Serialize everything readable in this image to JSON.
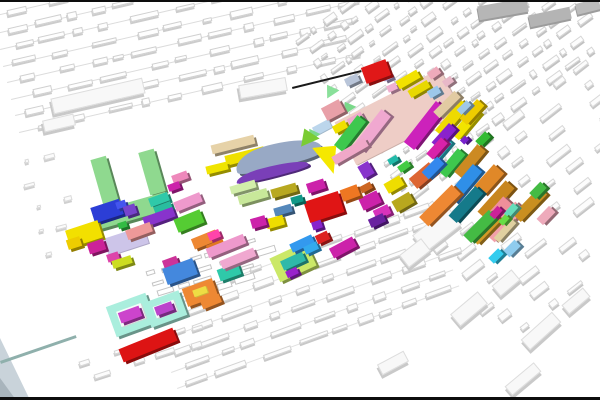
{
  "scene": {
    "width": 600,
    "height": 400,
    "background": "#ffffff",
    "bars": [
      {
        "y": 0,
        "h": 2,
        "color": "#0d0d0d"
      },
      {
        "y": 397,
        "h": 3,
        "color": "#0d0d0d"
      }
    ],
    "corner_shapes": [
      {
        "x": 0,
        "y": 338,
        "w": 30,
        "h": 62,
        "clip": "polygon(0 0,100% 100%,0 100%)",
        "color": "#c9d3da"
      },
      {
        "x": 0,
        "y": 378,
        "w": 16,
        "h": 22,
        "clip": "polygon(0 0,100% 100%,0 100%)",
        "color": "#a8b4bc"
      }
    ],
    "lines": [
      {
        "cx": 327,
        "cy": 87,
        "len": 71,
        "h": 1.5,
        "angle": -13.8,
        "color": "#1a1a1a"
      },
      {
        "cx": 40,
        "cy": 361,
        "len": 80,
        "h": 3,
        "angle": -18.9,
        "color": "#8fb0ac"
      }
    ],
    "fields_format": "procedural white building rows: origin x/y, row angle deg, rows, row_gap px, row_len px, block w/h ranges, gap range, optional row line color",
    "fields": [
      {
        "seed": 11,
        "x": -8,
        "y": 16,
        "angle": -13,
        "rows": 8,
        "row_gap": 17,
        "row_len": 352,
        "bw": [
          8,
          30
        ],
        "bh": [
          4,
          7
        ],
        "gap": [
          5,
          26
        ],
        "line": "#dcdcdc",
        "fill": "#fefefe",
        "edge": "#d0d0d0",
        "sh": "#cccccc"
      },
      {
        "seed": 23,
        "x": 398,
        "y": 190,
        "angle": -36,
        "rows": 13,
        "row_gap": -15,
        "row_len": 255,
        "bw": [
          5,
          18
        ],
        "bh": [
          3,
          7
        ],
        "gap": [
          2,
          12
        ],
        "line": null,
        "fill": "#fdfdfd",
        "edge": "#d6d6d6",
        "sh": "#c2c2c2"
      },
      {
        "seed": 37,
        "x": 385,
        "y": 218,
        "angle": -38,
        "rows": 10,
        "row_gap": 19,
        "row_len": 270,
        "bw": [
          8,
          28
        ],
        "bh": [
          4,
          8
        ],
        "gap": [
          8,
          42
        ],
        "line": null,
        "fill": "#fcfcfc",
        "edge": "#d8d8d8",
        "sh": "#c6c6c6"
      },
      {
        "seed": 51,
        "x": 148,
        "y": 308,
        "angle": -20,
        "rows": 6,
        "row_gap": 17,
        "row_len": 300,
        "bw": [
          10,
          34
        ],
        "bh": [
          4,
          7
        ],
        "gap": [
          4,
          20
        ],
        "line": "#e2e2e2",
        "fill": "#fdfdfd",
        "edge": "#d4d4d4",
        "sh": "#c8c8c8"
      },
      {
        "seed": 63,
        "x": 142,
        "y": 276,
        "angle": -17,
        "rows": 4,
        "row_gap": 11,
        "row_len": 122,
        "bw": [
          8,
          26
        ],
        "bh": [
          4,
          7
        ],
        "gap": [
          3,
          10
        ],
        "line": null,
        "fill": "#ffffff",
        "edge": "#c4c4c4",
        "sh": null
      },
      {
        "seed": 77,
        "x": 2,
        "y": 168,
        "angle": -15,
        "rows": 5,
        "row_gap": 24,
        "row_len": 66,
        "bw": [
          4,
          12
        ],
        "bh": [
          3,
          5
        ],
        "gap": [
          12,
          40
        ],
        "line": null,
        "fill": "#fbfbfb",
        "edge": "#dadada",
        "sh": "#cfcfcf"
      },
      {
        "seed": 85,
        "x": 60,
        "y": 372,
        "angle": -18,
        "rows": 2,
        "row_gap": 15,
        "row_len": 150,
        "bw": [
          6,
          20
        ],
        "bh": [
          3,
          6
        ],
        "gap": [
          10,
          34
        ],
        "line": null,
        "fill": "#fcfcfc",
        "edge": "#d6d6d6",
        "sh": "#c9c9c9"
      }
    ],
    "gray_slabs": [
      [
        503,
        9,
        50,
        14,
        -10,
        "#b6b6b6"
      ],
      [
        550,
        17,
        42,
        12,
        -12,
        "#b4b4b4"
      ],
      [
        588,
        6,
        24,
        11,
        -14,
        "#bbbbbb"
      ]
    ],
    "white_slabs": [
      [
        97,
        95,
        92,
        14,
        -13
      ],
      [
        58,
        122,
        30,
        10,
        -13
      ],
      [
        262,
        87,
        46,
        12,
        -10
      ],
      [
        436,
        229,
        44,
        20,
        -38
      ],
      [
        414,
        252,
        26,
        14,
        -38
      ],
      [
        468,
        308,
        34,
        14,
        -40
      ],
      [
        540,
        330,
        40,
        12,
        -42
      ],
      [
        505,
        282,
        24,
        12,
        -40
      ],
      [
        392,
        362,
        28,
        10,
        -28
      ],
      [
        522,
        378,
        36,
        10,
        -40
      ],
      [
        575,
        300,
        26,
        10,
        -40
      ]
    ],
    "buildings_format": "[cx, cy, w, h, rot_deg, roof_color, shape(optional: flat|tri|wedge|arc|arc2)]",
    "buildings": [
      [
        398,
        117,
        118,
        48,
        -27,
        "#eecdc6",
        "flat"
      ],
      [
        126,
        241,
        42,
        18,
        -18,
        "#cdc5e9",
        "flat"
      ],
      [
        322,
        127,
        18,
        9,
        -28,
        "#bcd6ec",
        "flat"
      ],
      [
        352,
        80,
        14,
        8,
        -25,
        "#b9c5d9"
      ],
      [
        387,
        77,
        9,
        6,
        -25,
        "#b4a4d6"
      ],
      [
        376,
        71,
        26,
        17,
        -20,
        "#e01818"
      ],
      [
        392,
        87,
        10,
        7,
        -25,
        "#f0b0d0"
      ],
      [
        408,
        79,
        24,
        9,
        -30,
        "#f2e200"
      ],
      [
        419,
        89,
        22,
        8,
        -30,
        "#e8d800"
      ],
      [
        434,
        92,
        12,
        8,
        -30,
        "#9cc8ea"
      ],
      [
        434,
        73,
        12,
        8,
        -35,
        "#eeaabb"
      ],
      [
        448,
        81,
        10,
        7,
        -35,
        "#e8b8c8"
      ],
      [
        330,
        90,
        16,
        12,
        -30,
        "#8ae09a",
        "tri"
      ],
      [
        347,
        106,
        15,
        11,
        -30,
        "#7ad88a",
        "tri"
      ],
      [
        333,
        110,
        20,
        14,
        -28,
        "#e8a0a8"
      ],
      [
        312,
        133,
        14,
        11,
        -30,
        "#7ad88a",
        "tri"
      ],
      [
        340,
        127,
        14,
        8,
        -28,
        "#f0e000"
      ],
      [
        356,
        120,
        16,
        10,
        -30,
        "#eeaacc"
      ],
      [
        350,
        133,
        38,
        11,
        -52,
        "#3ec84e"
      ],
      [
        372,
        131,
        46,
        12,
        -52,
        "#f0a8d0"
      ],
      [
        425,
        125,
        52,
        13,
        -52,
        "#cc22bb"
      ],
      [
        441,
        149,
        24,
        9,
        -50,
        "#2fb9c9"
      ],
      [
        452,
        118,
        40,
        11,
        -50,
        "#eeda00"
      ],
      [
        466,
        124,
        34,
        10,
        -50,
        "#f2e400"
      ],
      [
        447,
        104,
        30,
        9,
        -45,
        "#e2cba2"
      ],
      [
        472,
        112,
        26,
        10,
        -48,
        "#eecc00"
      ],
      [
        444,
        136,
        26,
        10,
        -48,
        "#8a22cc"
      ],
      [
        437,
        148,
        22,
        9,
        -48,
        "#d822aa"
      ],
      [
        464,
        107,
        14,
        7,
        -45,
        "#a0c8e8"
      ],
      [
        483,
        139,
        14,
        8,
        -45,
        "#33bb33"
      ],
      [
        464,
        140,
        7,
        6,
        -45,
        "#7722cc"
      ],
      [
        452,
        163,
        30,
        10,
        -50,
        "#3ec84e"
      ],
      [
        470,
        161,
        36,
        11,
        -50,
        "#cc8a22"
      ],
      [
        464,
        184,
        42,
        12,
        -50,
        "#2f8fe8"
      ],
      [
        489,
        180,
        30,
        14,
        -48,
        "#e08828"
      ],
      [
        440,
        205,
        46,
        13,
        -45,
        "#ee8833"
      ],
      [
        466,
        204,
        40,
        11,
        -48,
        "#157a8a"
      ],
      [
        496,
        200,
        42,
        12,
        -48,
        "#c8861e"
      ],
      [
        492,
        218,
        48,
        13,
        -48,
        "#ef8f9a"
      ],
      [
        505,
        222,
        44,
        12,
        -48,
        "#f2a0aa"
      ],
      [
        486,
        229,
        34,
        10,
        -46,
        "#d29a26"
      ],
      [
        530,
        204,
        38,
        11,
        -46,
        "#c98f20"
      ],
      [
        538,
        190,
        16,
        9,
        -46,
        "#44bb44"
      ],
      [
        546,
        215,
        18,
        9,
        -46,
        "#eeaabb"
      ],
      [
        505,
        230,
        26,
        7,
        -48,
        "#e0d0a0"
      ],
      [
        511,
        210,
        14,
        7,
        -48,
        "#66ddbb"
      ],
      [
        512,
        248,
        16,
        9,
        -45,
        "#8fccee"
      ],
      [
        496,
        256,
        14,
        8,
        -45,
        "#33ccee"
      ],
      [
        480,
        226,
        36,
        11,
        -45,
        "#44bb44"
      ],
      [
        496,
        212,
        12,
        7,
        -48,
        "#cc2299"
      ],
      [
        504,
        220,
        10,
        6,
        -48,
        "#66dd44"
      ],
      [
        366,
        170,
        12,
        14,
        -30,
        "#8833cc"
      ],
      [
        366,
        187,
        12,
        7,
        -28,
        "#cc6622"
      ],
      [
        370,
        200,
        20,
        13,
        -25,
        "#cc22aa"
      ],
      [
        382,
        212,
        16,
        10,
        -25,
        "#d833bb"
      ],
      [
        394,
        184,
        18,
        11,
        -30,
        "#eedd00"
      ],
      [
        403,
        202,
        20,
        12,
        -30,
        "#b8a81e"
      ],
      [
        377,
        220,
        16,
        9,
        -25,
        "#6a22a0"
      ],
      [
        393,
        160,
        10,
        6,
        -30,
        "#22bbaa"
      ],
      [
        404,
        166,
        12,
        7,
        -35,
        "#44cc44"
      ],
      [
        423,
        175,
        26,
        13,
        -40,
        "#dd6633"
      ],
      [
        433,
        168,
        22,
        10,
        -45,
        "#3388ee"
      ],
      [
        233,
        144,
        44,
        9,
        -14,
        "#e6d2a8"
      ],
      [
        245,
        156,
        40,
        10,
        -14,
        "#efe000"
      ],
      [
        217,
        168,
        22,
        8,
        -14,
        "#f0e400"
      ],
      [
        278,
        155,
        88,
        24,
        -16,
        "#98a9c5",
        "arc"
      ],
      [
        272,
        171,
        74,
        11,
        -15,
        "#7a3fb8",
        "arc2"
      ],
      [
        307,
        136,
        22,
        16,
        -20,
        "#7acc33",
        "tri"
      ],
      [
        327,
        160,
        24,
        30,
        -12,
        "#f5e800",
        "wedge"
      ],
      [
        350,
        151,
        38,
        9,
        -30,
        "#f0a8c8"
      ],
      [
        253,
        196,
        30,
        9,
        -16,
        "#c8e89a"
      ],
      [
        243,
        187,
        26,
        8,
        -16,
        "#d2eeaa"
      ],
      [
        284,
        190,
        26,
        9,
        -16,
        "#b8a820"
      ],
      [
        316,
        186,
        18,
        10,
        -18,
        "#cc22aa"
      ],
      [
        324,
        207,
        36,
        22,
        -18,
        "#e01515"
      ],
      [
        350,
        193,
        18,
        12,
        -20,
        "#ee7722"
      ],
      [
        297,
        199,
        12,
        7,
        -16,
        "#119988"
      ],
      [
        283,
        210,
        18,
        8,
        -16,
        "#5588bb"
      ],
      [
        275,
        222,
        18,
        10,
        -16,
        "#eedd00"
      ],
      [
        258,
        222,
        15,
        10,
        -16,
        "#cc22aa"
      ],
      [
        317,
        225,
        10,
        8,
        -18,
        "#8822cc"
      ],
      [
        105,
        182,
        16,
        50,
        -16,
        "#8fd98f"
      ],
      [
        152,
        172,
        16,
        44,
        -16,
        "#8fd98f"
      ],
      [
        131,
        211,
        76,
        18,
        -16,
        "#8fd98f"
      ],
      [
        107,
        211,
        30,
        16,
        -18,
        "#2c3ed6"
      ],
      [
        121,
        204,
        10,
        7,
        -18,
        "#4455ee"
      ],
      [
        130,
        210,
        12,
        10,
        -18,
        "#7744cc"
      ],
      [
        122,
        225,
        9,
        6,
        -18,
        "#33bb44"
      ],
      [
        84,
        234,
        34,
        18,
        -18,
        "#f2e000"
      ],
      [
        74,
        243,
        14,
        10,
        -18,
        "#eecc00"
      ],
      [
        96,
        246,
        17,
        11,
        -18,
        "#cc2299"
      ],
      [
        113,
        257,
        12,
        8,
        -18,
        "#dd44aa"
      ],
      [
        122,
        262,
        20,
        8,
        -18,
        "#ccdd22"
      ],
      [
        159,
        199,
        20,
        9,
        -20,
        "#2fc9a9"
      ],
      [
        163,
        208,
        18,
        8,
        -20,
        "#29bd9f"
      ],
      [
        159,
        217,
        32,
        10,
        -20,
        "#8833cc"
      ],
      [
        188,
        202,
        28,
        10,
        -22,
        "#ee99cc"
      ],
      [
        180,
        177,
        16,
        8,
        -20,
        "#ee88bb"
      ],
      [
        174,
        186,
        12,
        7,
        -20,
        "#cc22aa"
      ],
      [
        189,
        221,
        28,
        14,
        -22,
        "#55cc33"
      ],
      [
        139,
        231,
        26,
        10,
        -20,
        "#ee9999"
      ],
      [
        205,
        239,
        26,
        11,
        -22,
        "#ee8833"
      ],
      [
        216,
        247,
        18,
        10,
        -22,
        "#e07722"
      ],
      [
        170,
        262,
        15,
        9,
        -20,
        "#cc3399"
      ],
      [
        180,
        271,
        32,
        17,
        -20,
        "#4488dd"
      ],
      [
        229,
        272,
        22,
        12,
        -20,
        "#2fc9a9"
      ],
      [
        200,
        292,
        32,
        19,
        -20,
        "#ee8833"
      ],
      [
        200,
        291,
        14,
        7,
        -20,
        "#eedd44",
        "flat"
      ],
      [
        211,
        301,
        20,
        9,
        -22,
        "#ee8833"
      ],
      [
        131,
        315,
        42,
        32,
        -20,
        "#aaeedd"
      ],
      [
        131,
        315,
        26,
        16,
        -20,
        "#f4fcf9",
        "flat"
      ],
      [
        130,
        314,
        22,
        11,
        -20,
        "#cc44cc"
      ],
      [
        165,
        309,
        38,
        26,
        -20,
        "#aaeedd"
      ],
      [
        165,
        309,
        22,
        12,
        -20,
        "#f4fcf9",
        "flat"
      ],
      [
        164,
        308,
        18,
        9,
        -20,
        "#bb44cc"
      ],
      [
        148,
        345,
        58,
        14,
        -22,
        "#dd1414"
      ],
      [
        214,
        235,
        12,
        8,
        -22,
        "#ff44aa"
      ],
      [
        226,
        246,
        40,
        10,
        -22,
        "#ee99cc"
      ],
      [
        238,
        258,
        36,
        9,
        -22,
        "#f0a8d0"
      ],
      [
        293,
        262,
        40,
        26,
        -25,
        "#cbe868"
      ],
      [
        293,
        261,
        24,
        10,
        -25,
        "#2fb9a9"
      ],
      [
        292,
        272,
        12,
        7,
        -25,
        "#9922cc"
      ],
      [
        302,
        243,
        24,
        9,
        -25,
        "#3399ee"
      ],
      [
        311,
        248,
        14,
        8,
        -25,
        "#33aaee"
      ],
      [
        322,
        237,
        13,
        9,
        -25,
        "#dd2222"
      ],
      [
        343,
        247,
        26,
        11,
        -28,
        "#cc22aa"
      ]
    ]
  }
}
